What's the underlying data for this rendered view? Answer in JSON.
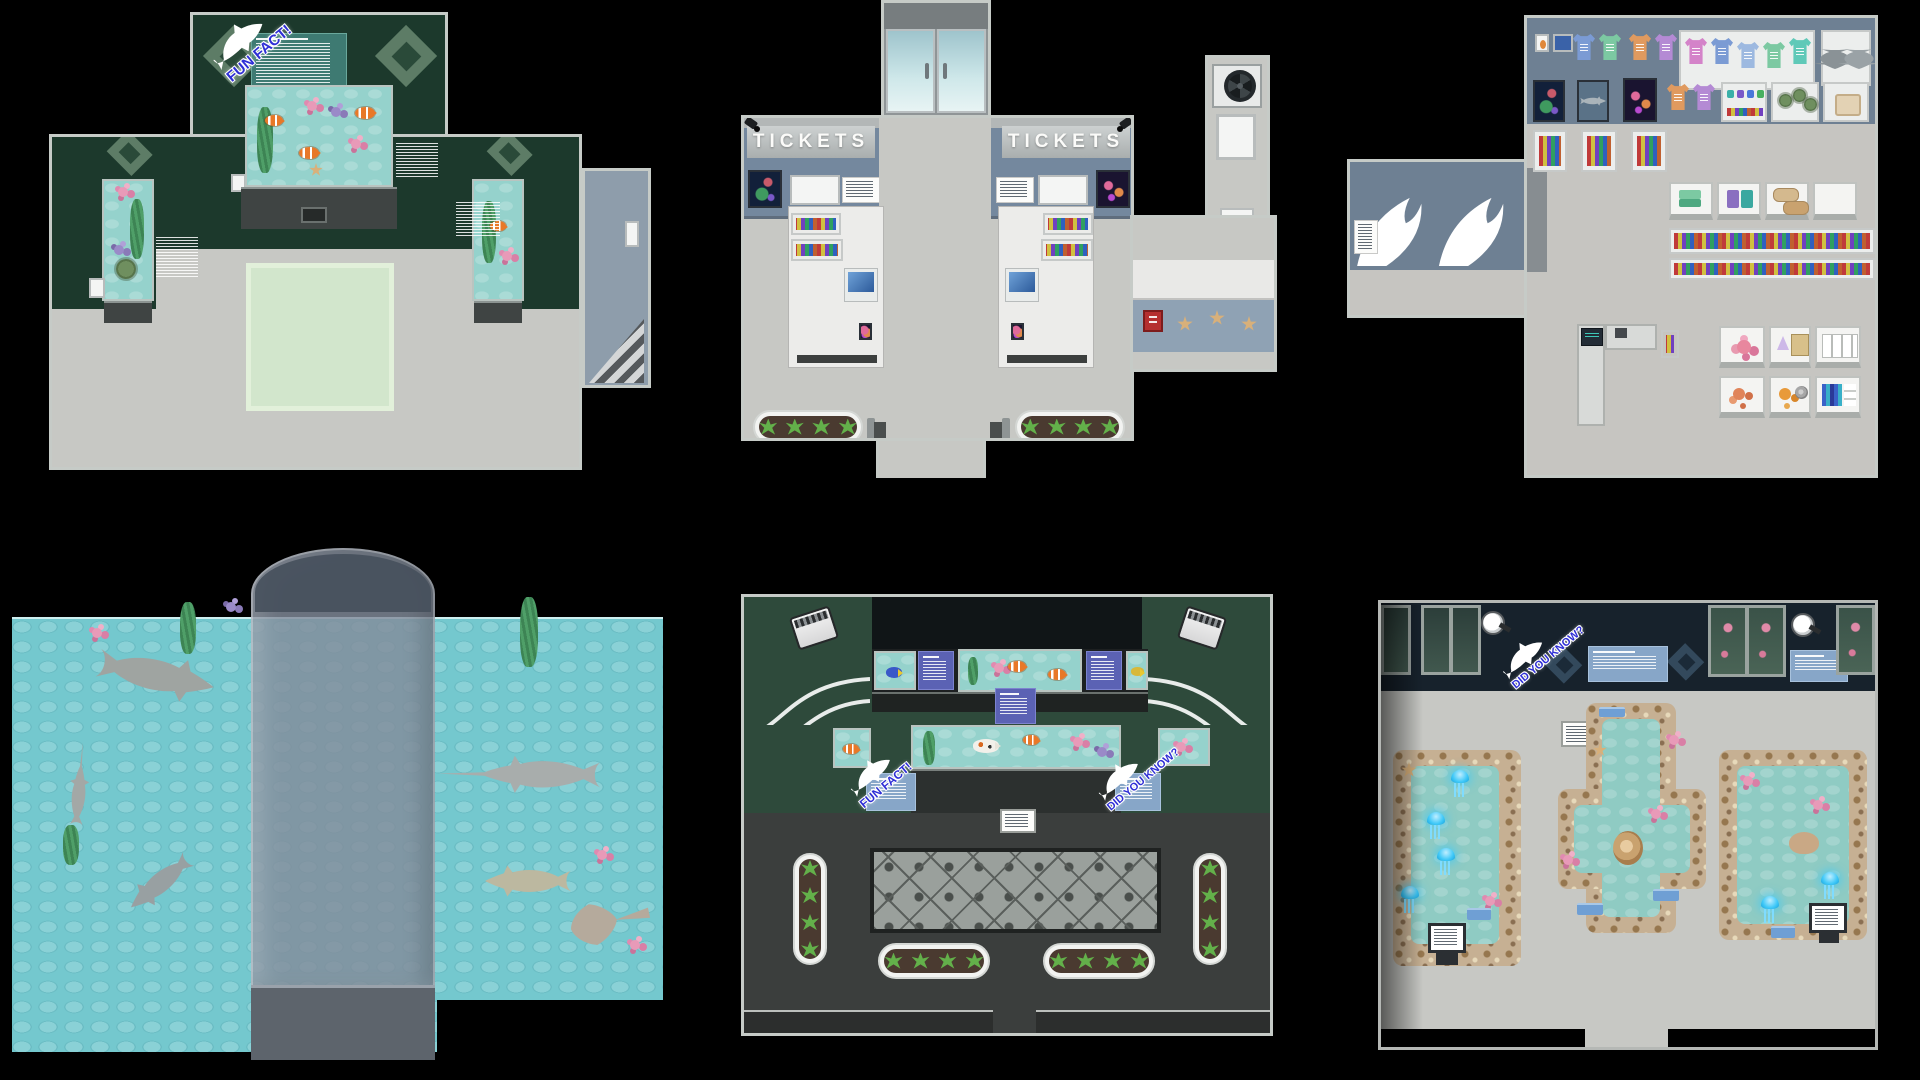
{
  "maps": {
    "exhibit_room": {
      "fun_fact_sign": "FUN FACT!"
    },
    "ticket_hall": {
      "left_booth_sign": "TICKETS",
      "right_booth_sign": "TICKETS"
    },
    "gift_shop": {},
    "shark_lagoon": {},
    "gallery_hall": {
      "fun_fact_sign": "FUN FACT!",
      "did_you_know_sign": "DID YOU KNOW?"
    },
    "touch_pool_room": {
      "did_you_know_sign": "DID YOU KNOW?"
    }
  },
  "icons": {
    "fun_fact_mascot": "shark-silhouette",
    "did_you_know_mascot": "orca-silhouette",
    "booth_camera": "security-camera"
  },
  "colors": {
    "background": "#000000",
    "exhibit_wall_green": "#1c392c",
    "gallery_wall_green": "#2e4a3b",
    "ticket_wall_blue": "#74889e",
    "gift_shop_wall_blue": "#6e8093",
    "navy_wall": "#17222c",
    "floor_gray": "#c7c8c4",
    "charcoal_floor": "#3b3e3d",
    "lagoon_water": "#74c8ce",
    "tank_water": "#95d2cc",
    "pool_water": "#8fcbc3",
    "stone_tan": "#c6b093",
    "sign_text_blue": "#2f2fd6",
    "plaque_teal": "#3e7a72",
    "plaque_purple": "#5b62b4",
    "plaque_blue": "#87a6c8",
    "jellyfish_blue": "#3ec8f8",
    "mat_green": "#d2e6cc"
  }
}
